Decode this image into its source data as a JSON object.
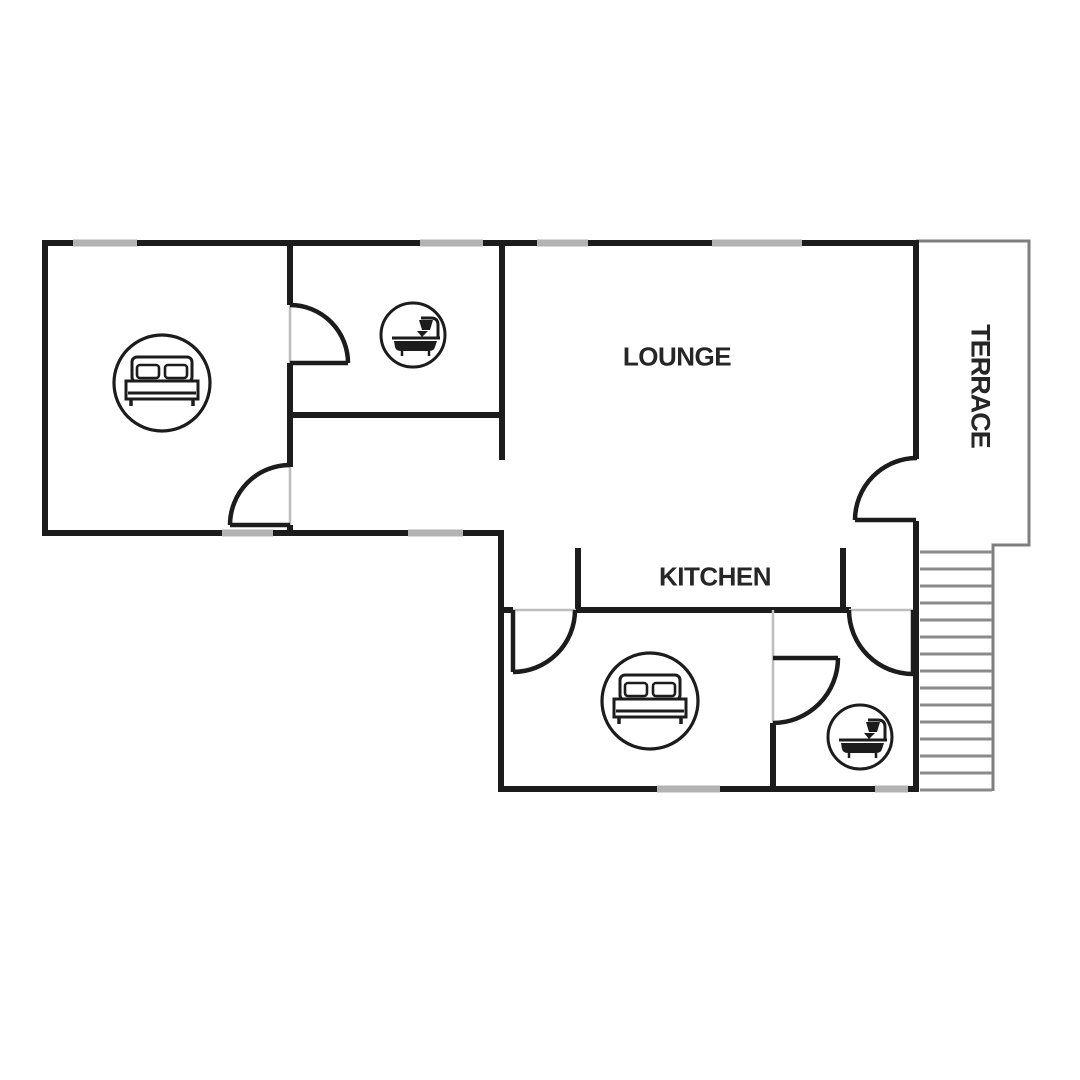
{
  "page": {
    "background": "#ffffff",
    "type": "apartment floor plan"
  },
  "floor_plan": {
    "labels": {
      "lounge": "LOUNGE",
      "kitchen": "KITCHEN",
      "terrace": "TERRACE"
    },
    "icons": [
      {
        "name": "double-bed-icon",
        "room": "bedroom-1"
      },
      {
        "name": "bathtub-shower-icon",
        "room": "bathroom-1"
      },
      {
        "name": "double-bed-icon",
        "room": "bedroom-2"
      },
      {
        "name": "bathtub-shower-icon",
        "room": "bathroom-2"
      }
    ],
    "colors": {
      "wall": "#1c1c1c",
      "window": "#b3b3b3",
      "threshold": "#bdbdbd",
      "terrace_outline": "#7f7f7f",
      "stair_tread": "#8a8a8a",
      "label_text": "#262626",
      "background": "#ffffff"
    },
    "stairs": {
      "tread_count": 15,
      "x1": 920,
      "x2": 992,
      "y_start": 552,
      "y_step": 17
    }
  }
}
